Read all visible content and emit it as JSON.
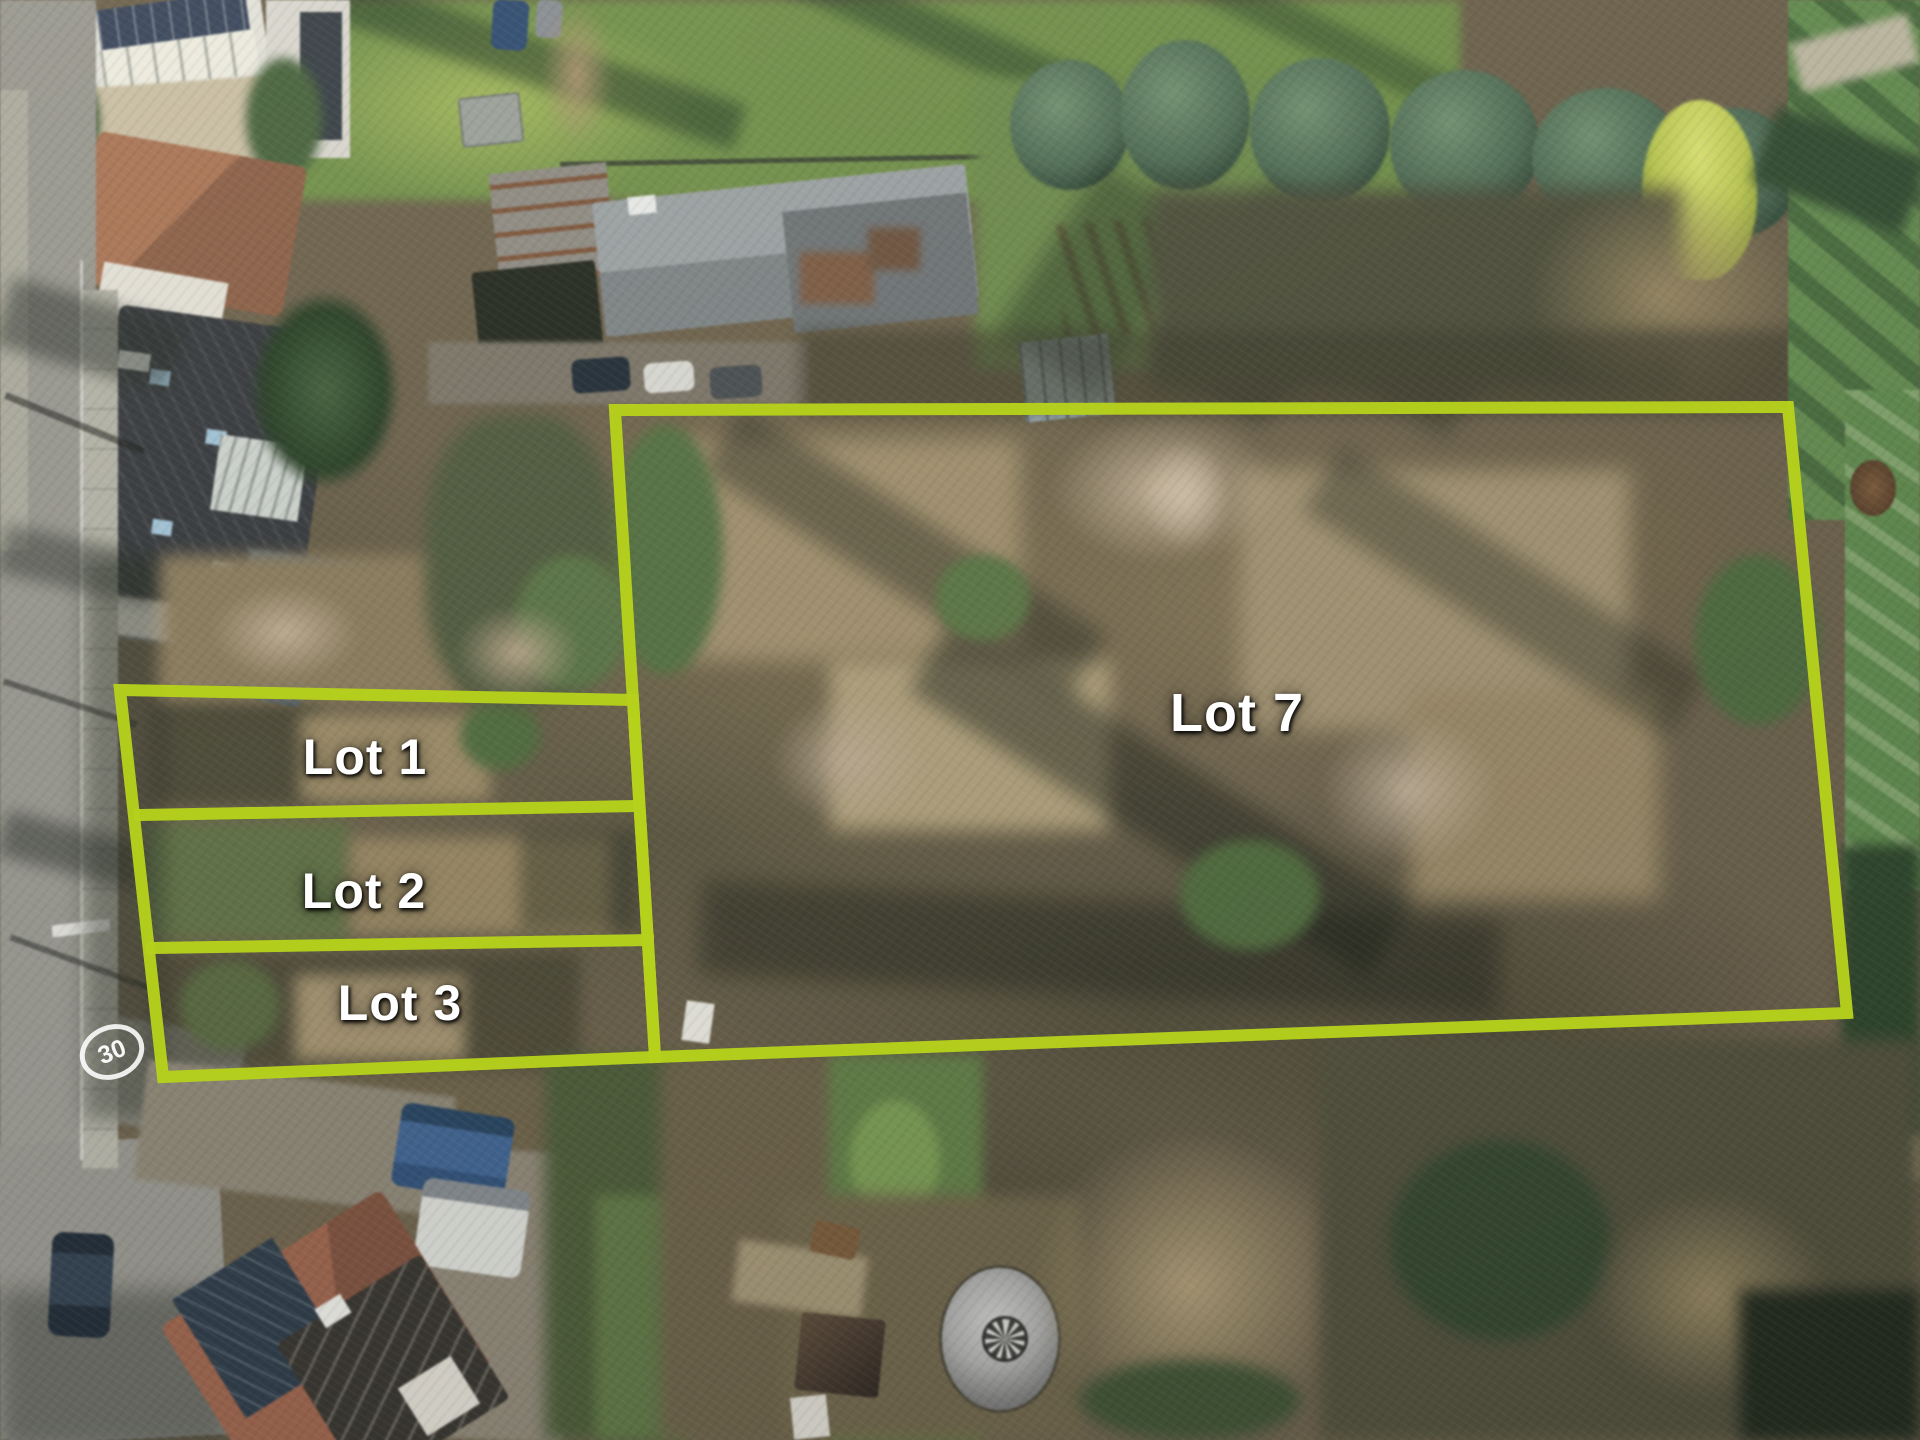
{
  "image": {
    "kind": "aerial-drone-photo",
    "description": "Winter aerial photograph of overgrown building plots outlined in chartreuse: three narrow strips (Lot 1, Lot 2, Lot 3) beside a residential street on the left and one large parcel (Lot 7) of bare scrub woodland, with houses and gardens along the top, a conifer row and lawns at top right, parked vans, a timber house and a metallic dome tank at the bottom.",
    "width_px": 1920,
    "height_px": 1440
  },
  "overlay": {
    "line_color": "#b6d11c",
    "label_color": "#ffffff",
    "lots": [
      {
        "id": "lot-1",
        "label": "Lot 1"
      },
      {
        "id": "lot-2",
        "label": "Lot 2"
      },
      {
        "id": "lot-3",
        "label": "Lot 3"
      },
      {
        "id": "lot-7",
        "label": "Lot 7"
      }
    ],
    "geometry": {
      "lot7_outline": "615,410 1788,407 1847,1013 655,1057",
      "strips_outline": "120,690 633,700 655,1057 163,1077",
      "divider_lot1_lot2": "140,815 639,806",
      "divider_lot2_lot3": "152,948 648,940"
    }
  },
  "road": {
    "speed_marking": "30"
  },
  "palette": {
    "boundary_chartreuse": "#b6d11c",
    "scrub_base": "#6b6049",
    "scrub_tan": "#a3916c",
    "lawn_green": "#6f8f46",
    "conifer_green": "#4c6b52",
    "bright_conifer": "#bcc94c",
    "road_gray": "#97968e",
    "red_roof": "#9b6148",
    "dome_gray": "#ababa9"
  }
}
